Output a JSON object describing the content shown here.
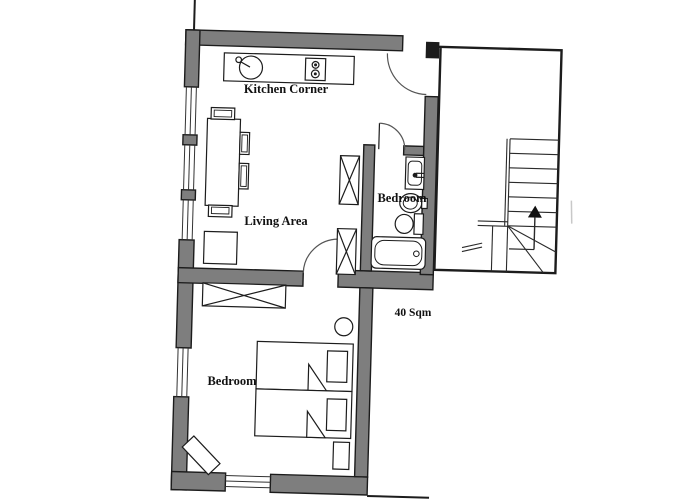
{
  "plan": {
    "type": "apartment-floor-plan",
    "area_label": "40 Sqm",
    "rooms": [
      {
        "id": "kitchen",
        "label": "Kitchen Corner"
      },
      {
        "id": "living",
        "label": "Living Area"
      },
      {
        "id": "bathroom",
        "label": "Bedroom"
      },
      {
        "id": "bedroom",
        "label": "Bedroom"
      }
    ],
    "fixtures": [
      "kitchen-counter",
      "kitchen-sink",
      "stove",
      "dining-table",
      "chairs",
      "side-table",
      "storage-cabinets-x",
      "washbasin",
      "bidet",
      "toilet",
      "bathtub",
      "wardrobe-x",
      "twin-bed",
      "twin-bed",
      "pillows",
      "nightstand",
      "stool",
      "rug",
      "staircase",
      "up-arrow"
    ],
    "colors": {
      "wall": "#7e7e7e",
      "line": "#1c1c1c",
      "door_arc": "#555555",
      "background": "#ffffff"
    }
  }
}
